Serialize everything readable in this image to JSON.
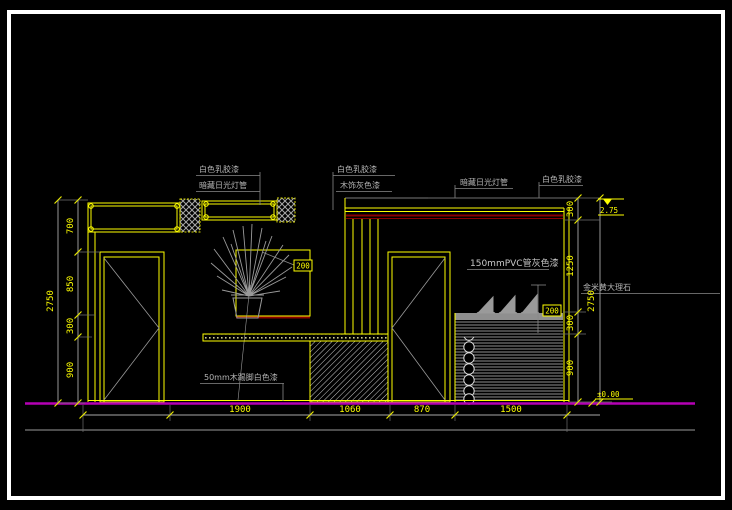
{
  "drawing": {
    "type": "interior-elevation-cad",
    "materials": {
      "tl_paint": "白色乳胶漆",
      "tl_light": "暗藏日光灯管",
      "tm_paint": "白色乳胶漆",
      "tm_wood": "木饰灰色漆",
      "tr_light": "暗藏日光灯管",
      "tr_paint": "白色乳胶漆",
      "pvc": "150mmPVC管灰色漆",
      "marble": "金米黄大理石",
      "skirting": "50mm木踢脚白色漆"
    },
    "callouts": {
      "niche_depth": "200",
      "ledge_depth": "200"
    },
    "levels": {
      "ceiling": "2.75",
      "floor": "±0.00"
    },
    "dimensions": {
      "left_overall": "2750",
      "left_chain": [
        "700",
        "850",
        "300",
        "900"
      ],
      "right_overall": "2750",
      "right_chain": [
        "300",
        "1250",
        "300",
        "900"
      ],
      "bottom_chain": [
        "1900",
        "1060",
        "870",
        "1500"
      ]
    },
    "colors": {
      "background": "#000000",
      "frame": "#ffffff",
      "primary_line": "#ffff00",
      "secondary_line": "#9a9a9a",
      "accent_red": "#8b0000",
      "floor_magenta": "#b400b4"
    }
  }
}
